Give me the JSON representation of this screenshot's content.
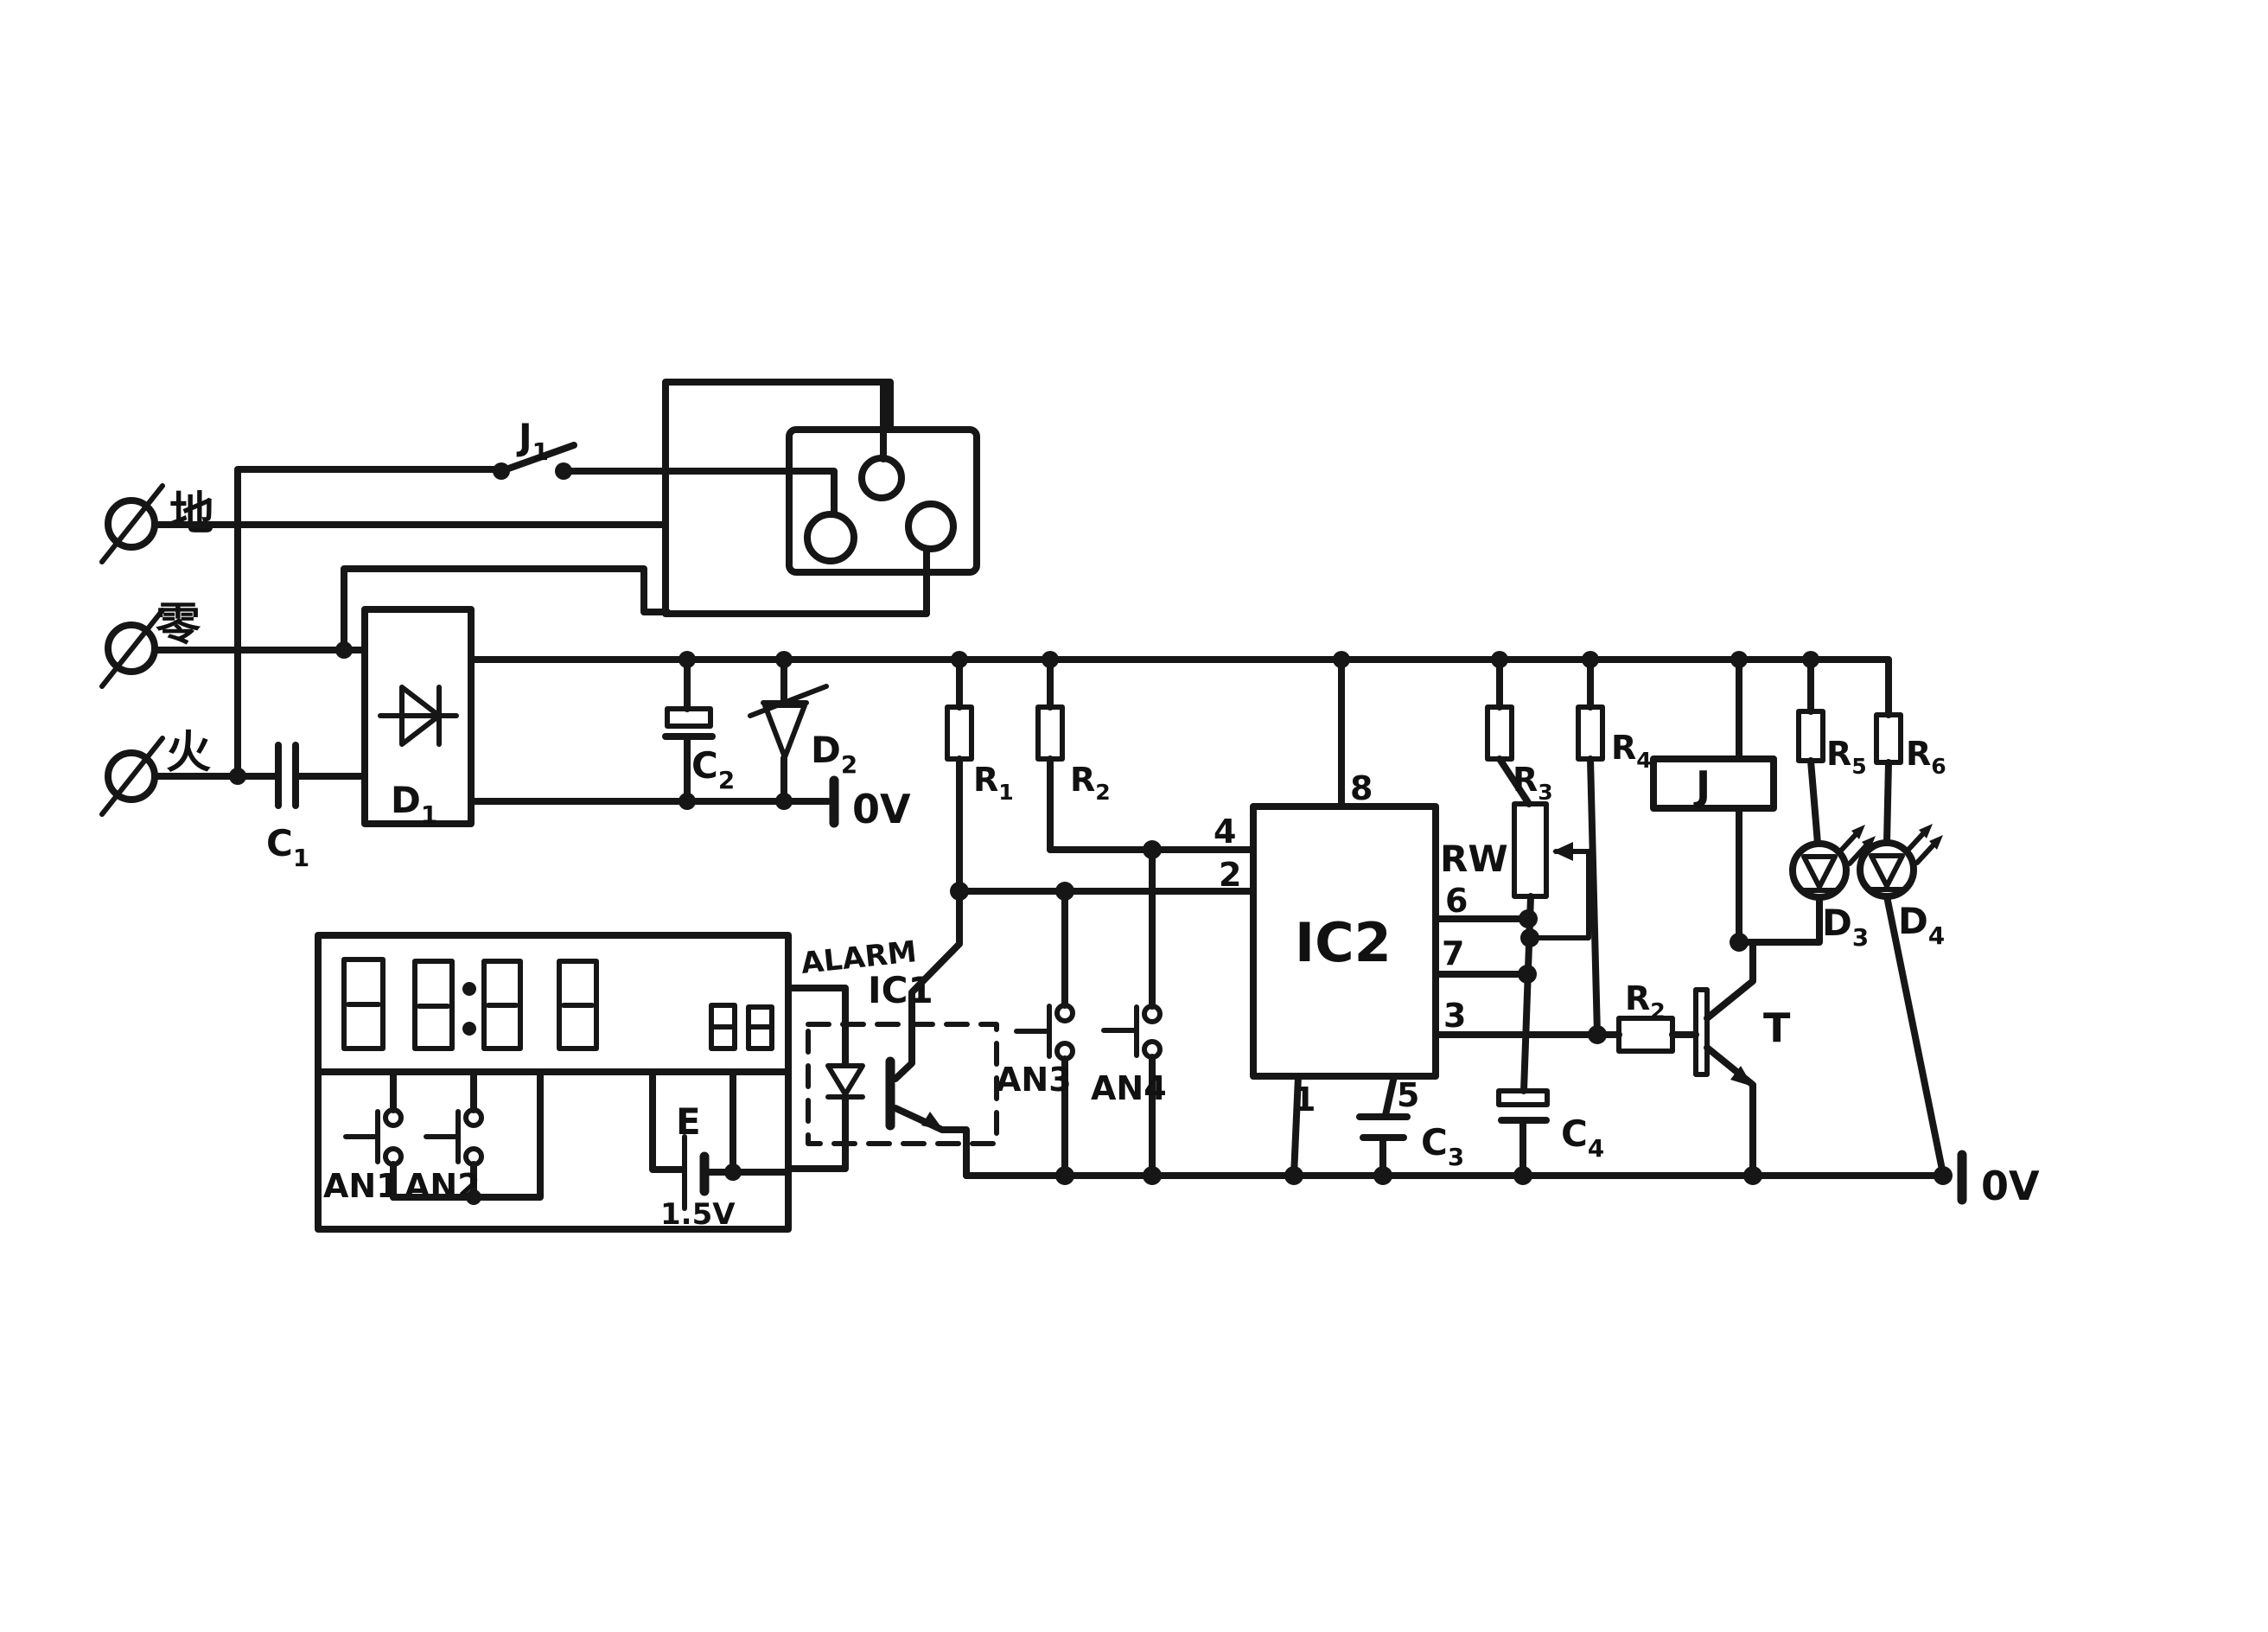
{
  "figure": {
    "kind": "hand-drawn circuit schematic",
    "ink_color": "#161616",
    "background_color": "#ffffff"
  },
  "terminals": {
    "earth": "地",
    "neutral": "零",
    "live": "火"
  },
  "switch": {
    "j1": {
      "main": "J",
      "sub": "1"
    }
  },
  "capacitors": {
    "c1": {
      "main": "C",
      "sub": "1"
    },
    "c2": {
      "main": "C",
      "sub": "2"
    },
    "c3": {
      "main": "C",
      "sub": "3"
    },
    "c4": {
      "main": "C",
      "sub": "4"
    }
  },
  "diodes": {
    "d1": {
      "main": "D",
      "sub": "1"
    },
    "d2": {
      "main": "D",
      "sub": "2"
    },
    "d3": {
      "main": "D",
      "sub": "3"
    },
    "d4": {
      "main": "D",
      "sub": "4"
    }
  },
  "resistors": {
    "r1": {
      "main": "R",
      "sub": "1"
    },
    "r2": {
      "main": "R",
      "sub": "2"
    },
    "r3": {
      "main": "R",
      "sub": "3"
    },
    "r4": {
      "main": "R",
      "sub": "4"
    },
    "r5": {
      "main": "R",
      "sub": "5"
    },
    "r6": {
      "main": "R",
      "sub": "6"
    },
    "base": {
      "main": "R",
      "sub": "2"
    },
    "potentiometer": "RW"
  },
  "grounds": {
    "ov1": "0V",
    "ov2": "0V"
  },
  "ics": {
    "ic1": "IC1",
    "ic2": "IC2",
    "alarm": "ALARM",
    "ic2_pins": {
      "p8": "8",
      "p4": "4",
      "p2": "2",
      "p6": "6",
      "p7": "7",
      "p3": "3",
      "p1": "1",
      "p5": "5"
    }
  },
  "buttons": {
    "an1": "AN1",
    "an2": "AN2",
    "an3": "AN3",
    "an4": "AN4"
  },
  "battery": {
    "label": "E",
    "voltage": "1.5V"
  },
  "transistor": {
    "t": "T"
  },
  "relay": {
    "j": "J"
  }
}
